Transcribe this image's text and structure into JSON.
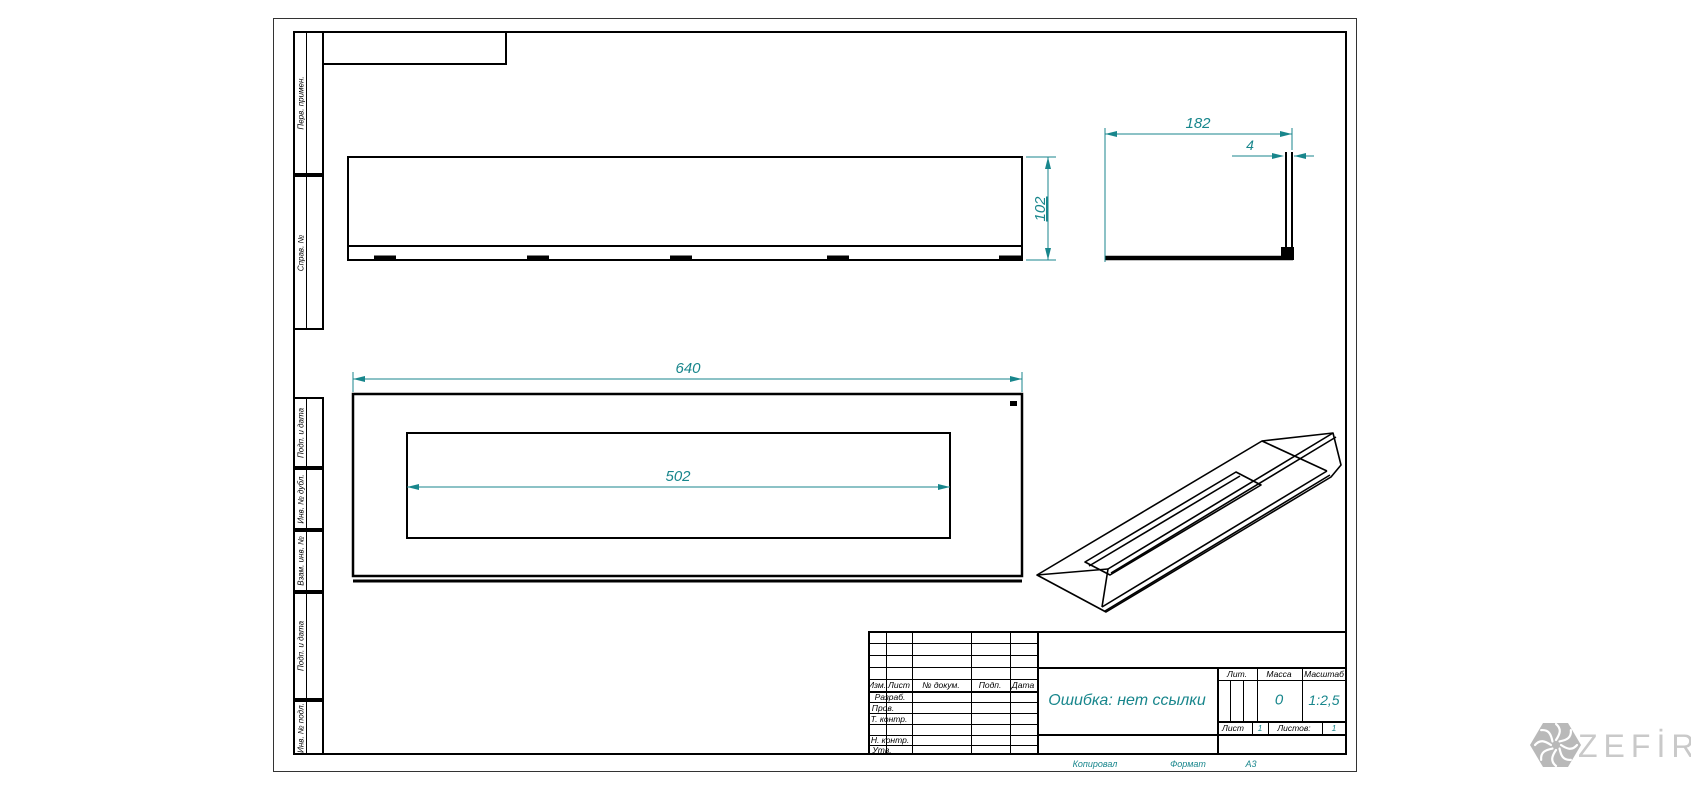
{
  "dims": {
    "total_width": "182",
    "flange": "4",
    "height": "102",
    "length": "640",
    "slot": "502"
  },
  "strips": [
    "Перв. примен.",
    "Справ. №",
    "Подп. и дата",
    "Инв. № дубл.",
    "Взам. инв. №",
    "Подп. и дата",
    "Инв. № подл."
  ],
  "title_block": {
    "cols": [
      "Изм.",
      "Лист",
      "№ докум.",
      "Подп.",
      "Дата"
    ],
    "row_labels": [
      "Разраб.",
      "Пров.",
      "Т. контр.",
      "Н. контр.",
      "Утв."
    ],
    "doc_name": "Ошибка: нет ссылки",
    "lit": "Лит.",
    "mass": "Масса",
    "scale": "Масштаб",
    "mass_value": "0",
    "scale_value": "1:2,5",
    "sheet": "Лист",
    "sheet_value": "1",
    "sheets": "Листов:",
    "sheets_value": "1",
    "copied": "Копировал",
    "format": "Формат",
    "format_value": "А3"
  },
  "logo": {
    "text": "ZEFİRE"
  },
  "colors": {
    "dimension": "#18868c",
    "line": "#000000",
    "logo_hex": "#b9b9b9",
    "logo_text": "#c9c9c9"
  }
}
